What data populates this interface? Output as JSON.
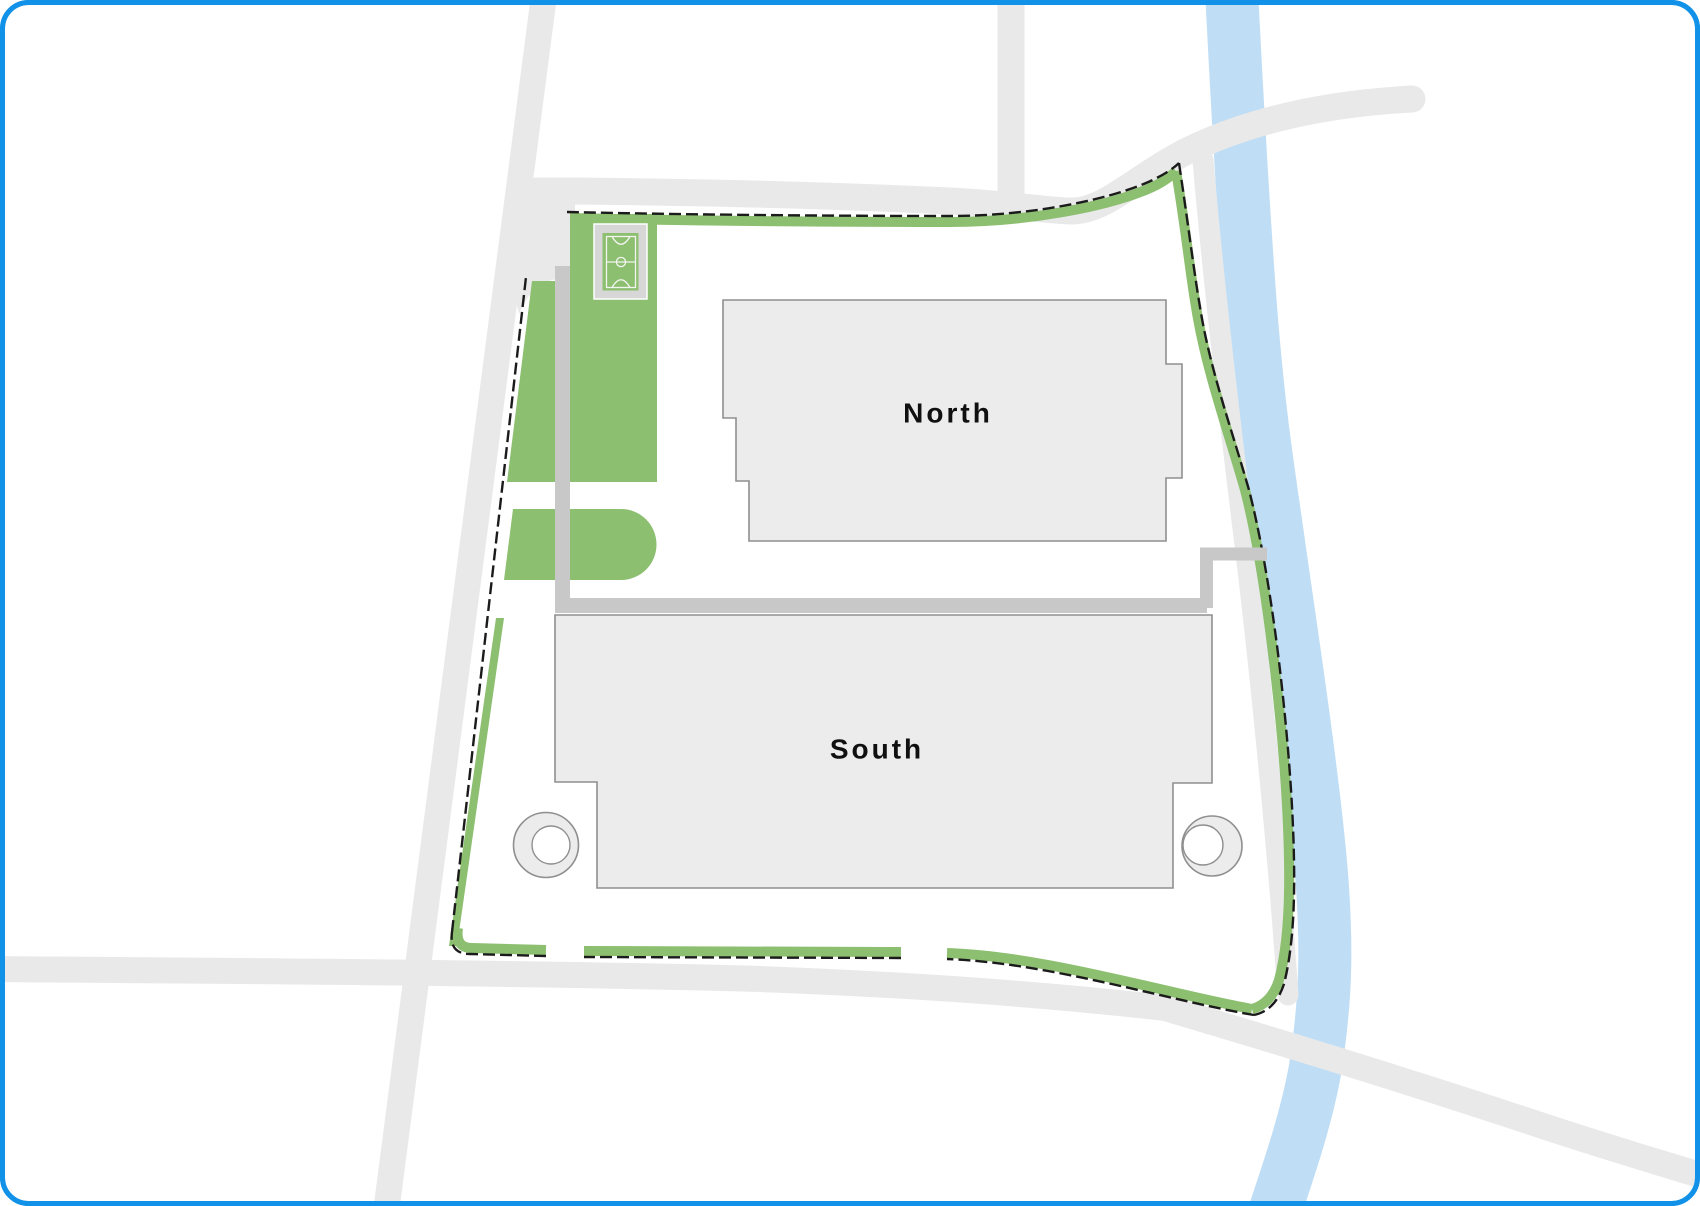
{
  "map": {
    "title": "Campus site plan",
    "buildings": [
      {
        "id": "north",
        "label": "North"
      },
      {
        "id": "south",
        "label": "South"
      }
    ],
    "features": {
      "sports_court_icon": "futsal-court-icon",
      "river": "river",
      "site_boundary": "site-boundary",
      "green_spaces": "lawns",
      "roads": "roads",
      "footpaths": "footpaths"
    }
  },
  "colors": {
    "frame": "#1191e8",
    "road": "#e9e9e9",
    "river": "#bfdef6",
    "green": "#8cbf6f",
    "path": "#c8c8c8",
    "building": "#ececec",
    "building-stroke": "#8f8f8f",
    "boundary-black": "#1b1b1b",
    "court-frame": "#d7d7d7",
    "court-line": "#f2f4ef",
    "label": "#101010"
  }
}
